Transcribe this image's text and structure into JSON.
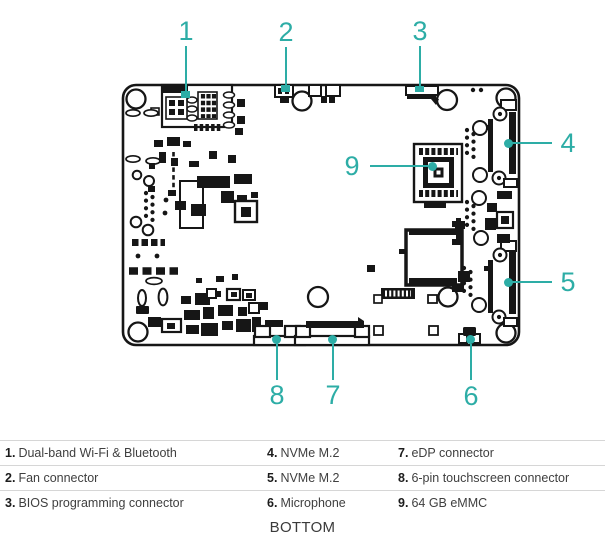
{
  "colors": {
    "accent": "#2dada6"
  },
  "diagram": {
    "caption": "BOTTOM",
    "callouts": {
      "c1": "1",
      "c2": "2",
      "c3": "3",
      "c4": "4",
      "c5": "5",
      "c6": "6",
      "c7": "7",
      "c8": "8",
      "c9": "9"
    }
  },
  "legend": {
    "rows": [
      {
        "col1": {
          "num": "1.",
          "label": "Dual-band Wi-Fi & Bluetooth"
        },
        "col2": {
          "num": "4.",
          "label": "NVMe M.2"
        },
        "col3": {
          "num": "7.",
          "label": "eDP connector"
        }
      },
      {
        "col1": {
          "num": "2.",
          "label": "Fan connector"
        },
        "col2": {
          "num": "5.",
          "label": "NVMe M.2"
        },
        "col3": {
          "num": "8.",
          "label": "6-pin touchscreen connector"
        }
      },
      {
        "col1": {
          "num": "3.",
          "label": "BIOS programming connector"
        },
        "col2": {
          "num": "6.",
          "label": "Microphone"
        },
        "col3": {
          "num": "9.",
          "label": "64 GB eMMC"
        }
      }
    ]
  }
}
